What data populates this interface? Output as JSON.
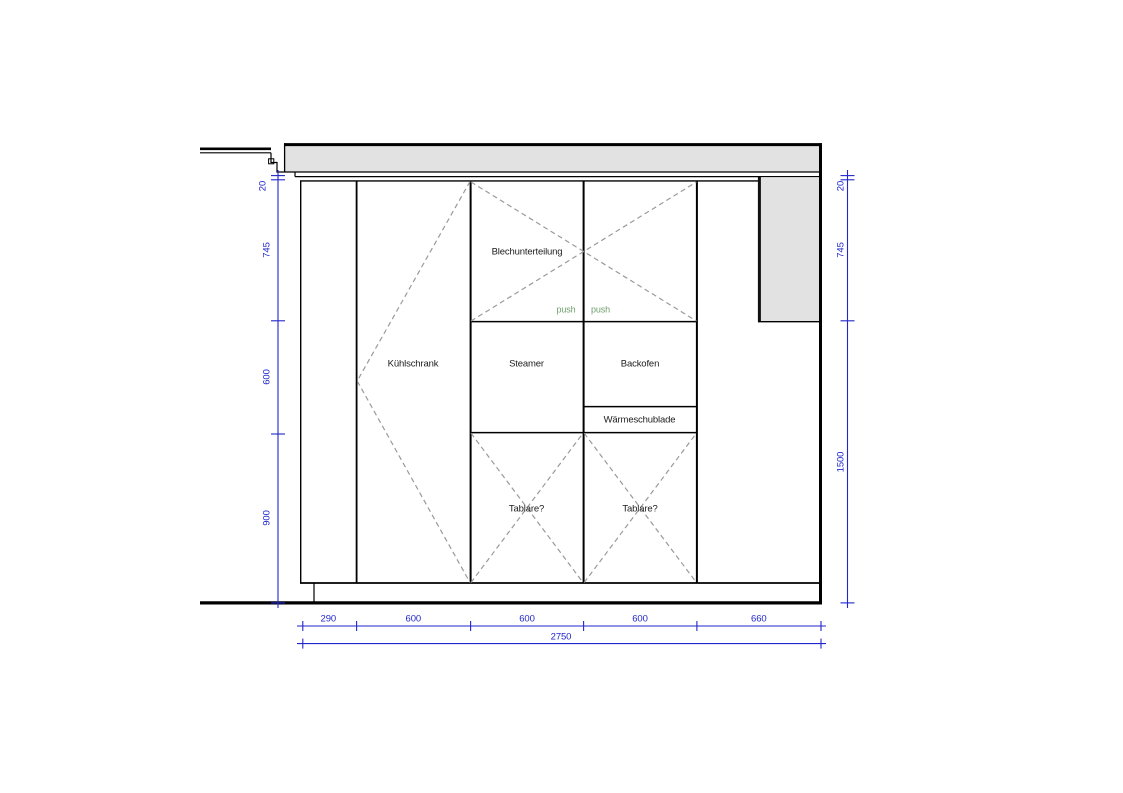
{
  "drawing": {
    "compartment_labels": {
      "fridge": "Kühlschrank",
      "sheet_divider": "Blechunterteilung",
      "steamer": "Steamer",
      "oven": "Backofen",
      "warming_drawer": "Wärmeschublade",
      "shelves_left": "Tablare?",
      "shelves_right": "Tablare?"
    },
    "push_labels": {
      "left": "push",
      "right": "push"
    },
    "dimensions": {
      "left_chain": {
        "gap": "20",
        "upper": "745",
        "middle": "600",
        "lower": "900"
      },
      "right_chain": {
        "gap": "20",
        "upper": "745",
        "lower": "1500"
      },
      "bottom_chain": {
        "seg1": "290",
        "seg2": "600",
        "seg3": "600",
        "seg4": "600",
        "seg5": "660"
      },
      "total_width": "2750"
    },
    "colors": {
      "dimension_blue": "#2126cc",
      "push_green": "#6f9e6f",
      "panel_gray": "#e2e2e2",
      "line_black": "#000000",
      "dashed_gray": "#9a9a9a"
    }
  }
}
